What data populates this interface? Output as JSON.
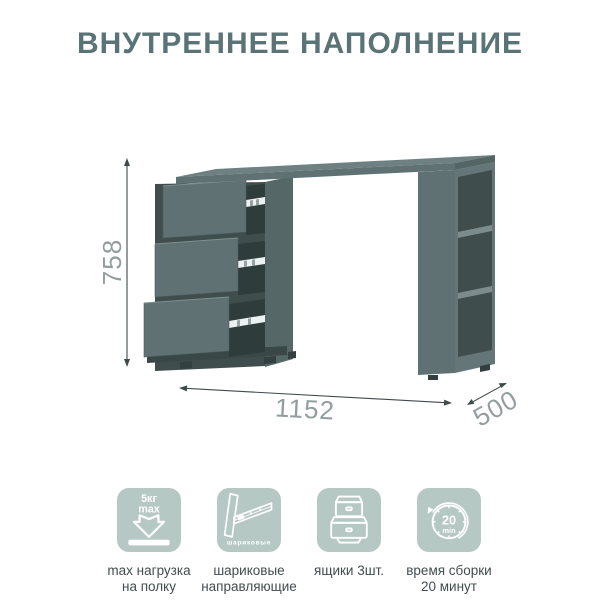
{
  "title": "ВНУТРЕННЕЕ НАПОЛНЕНИЕ",
  "dimensions": {
    "height": "758",
    "width": "1152",
    "depth": "500"
  },
  "features": [
    {
      "name": "max-load",
      "badge_top": "5кг",
      "badge_bottom": "max",
      "label_lines": [
        "max нагрузка",
        "на полку"
      ]
    },
    {
      "name": "ball-bearing-slides",
      "badge": "шариковые",
      "label_lines": [
        "шариковые",
        "направляющие"
      ]
    },
    {
      "name": "drawers-count",
      "label_lines": [
        "ящики 3шт."
      ]
    },
    {
      "name": "assembly-time",
      "badge_top": "20",
      "badge_bottom": "min",
      "label_lines": [
        "время сборки",
        "20 минут"
      ]
    }
  ],
  "colors": {
    "title": "#597376",
    "icon_background": "#b6c8c3",
    "icon_stroke": "#ffffff",
    "label_text": "#414d4e",
    "dimension_line": "#3f4a4b",
    "dimension_text": "#939d9e",
    "desk_top": "#6e8081",
    "desk_front": "#5f7172",
    "desk_interior": "#3f4d4d"
  }
}
